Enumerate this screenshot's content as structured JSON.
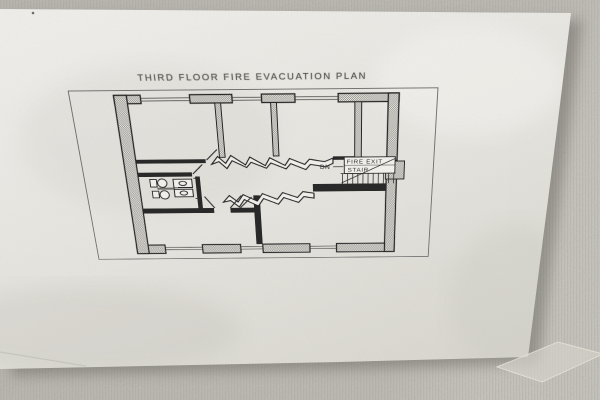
{
  "photo": {
    "title_text": "THIRD FLOOR FIRE EVACUATION PLAN",
    "stair": {
      "dn": "DN",
      "label_line1": "FIRE EXIT",
      "label_line2": "STAIR"
    }
  },
  "colors": {
    "wallpaper": "#b4b1aa",
    "paper": "#e9e7e2",
    "ink": "#1b1b1b",
    "faded_text": "#57544e",
    "shadow": "#6b6862",
    "tape": "#d3d0c7"
  }
}
